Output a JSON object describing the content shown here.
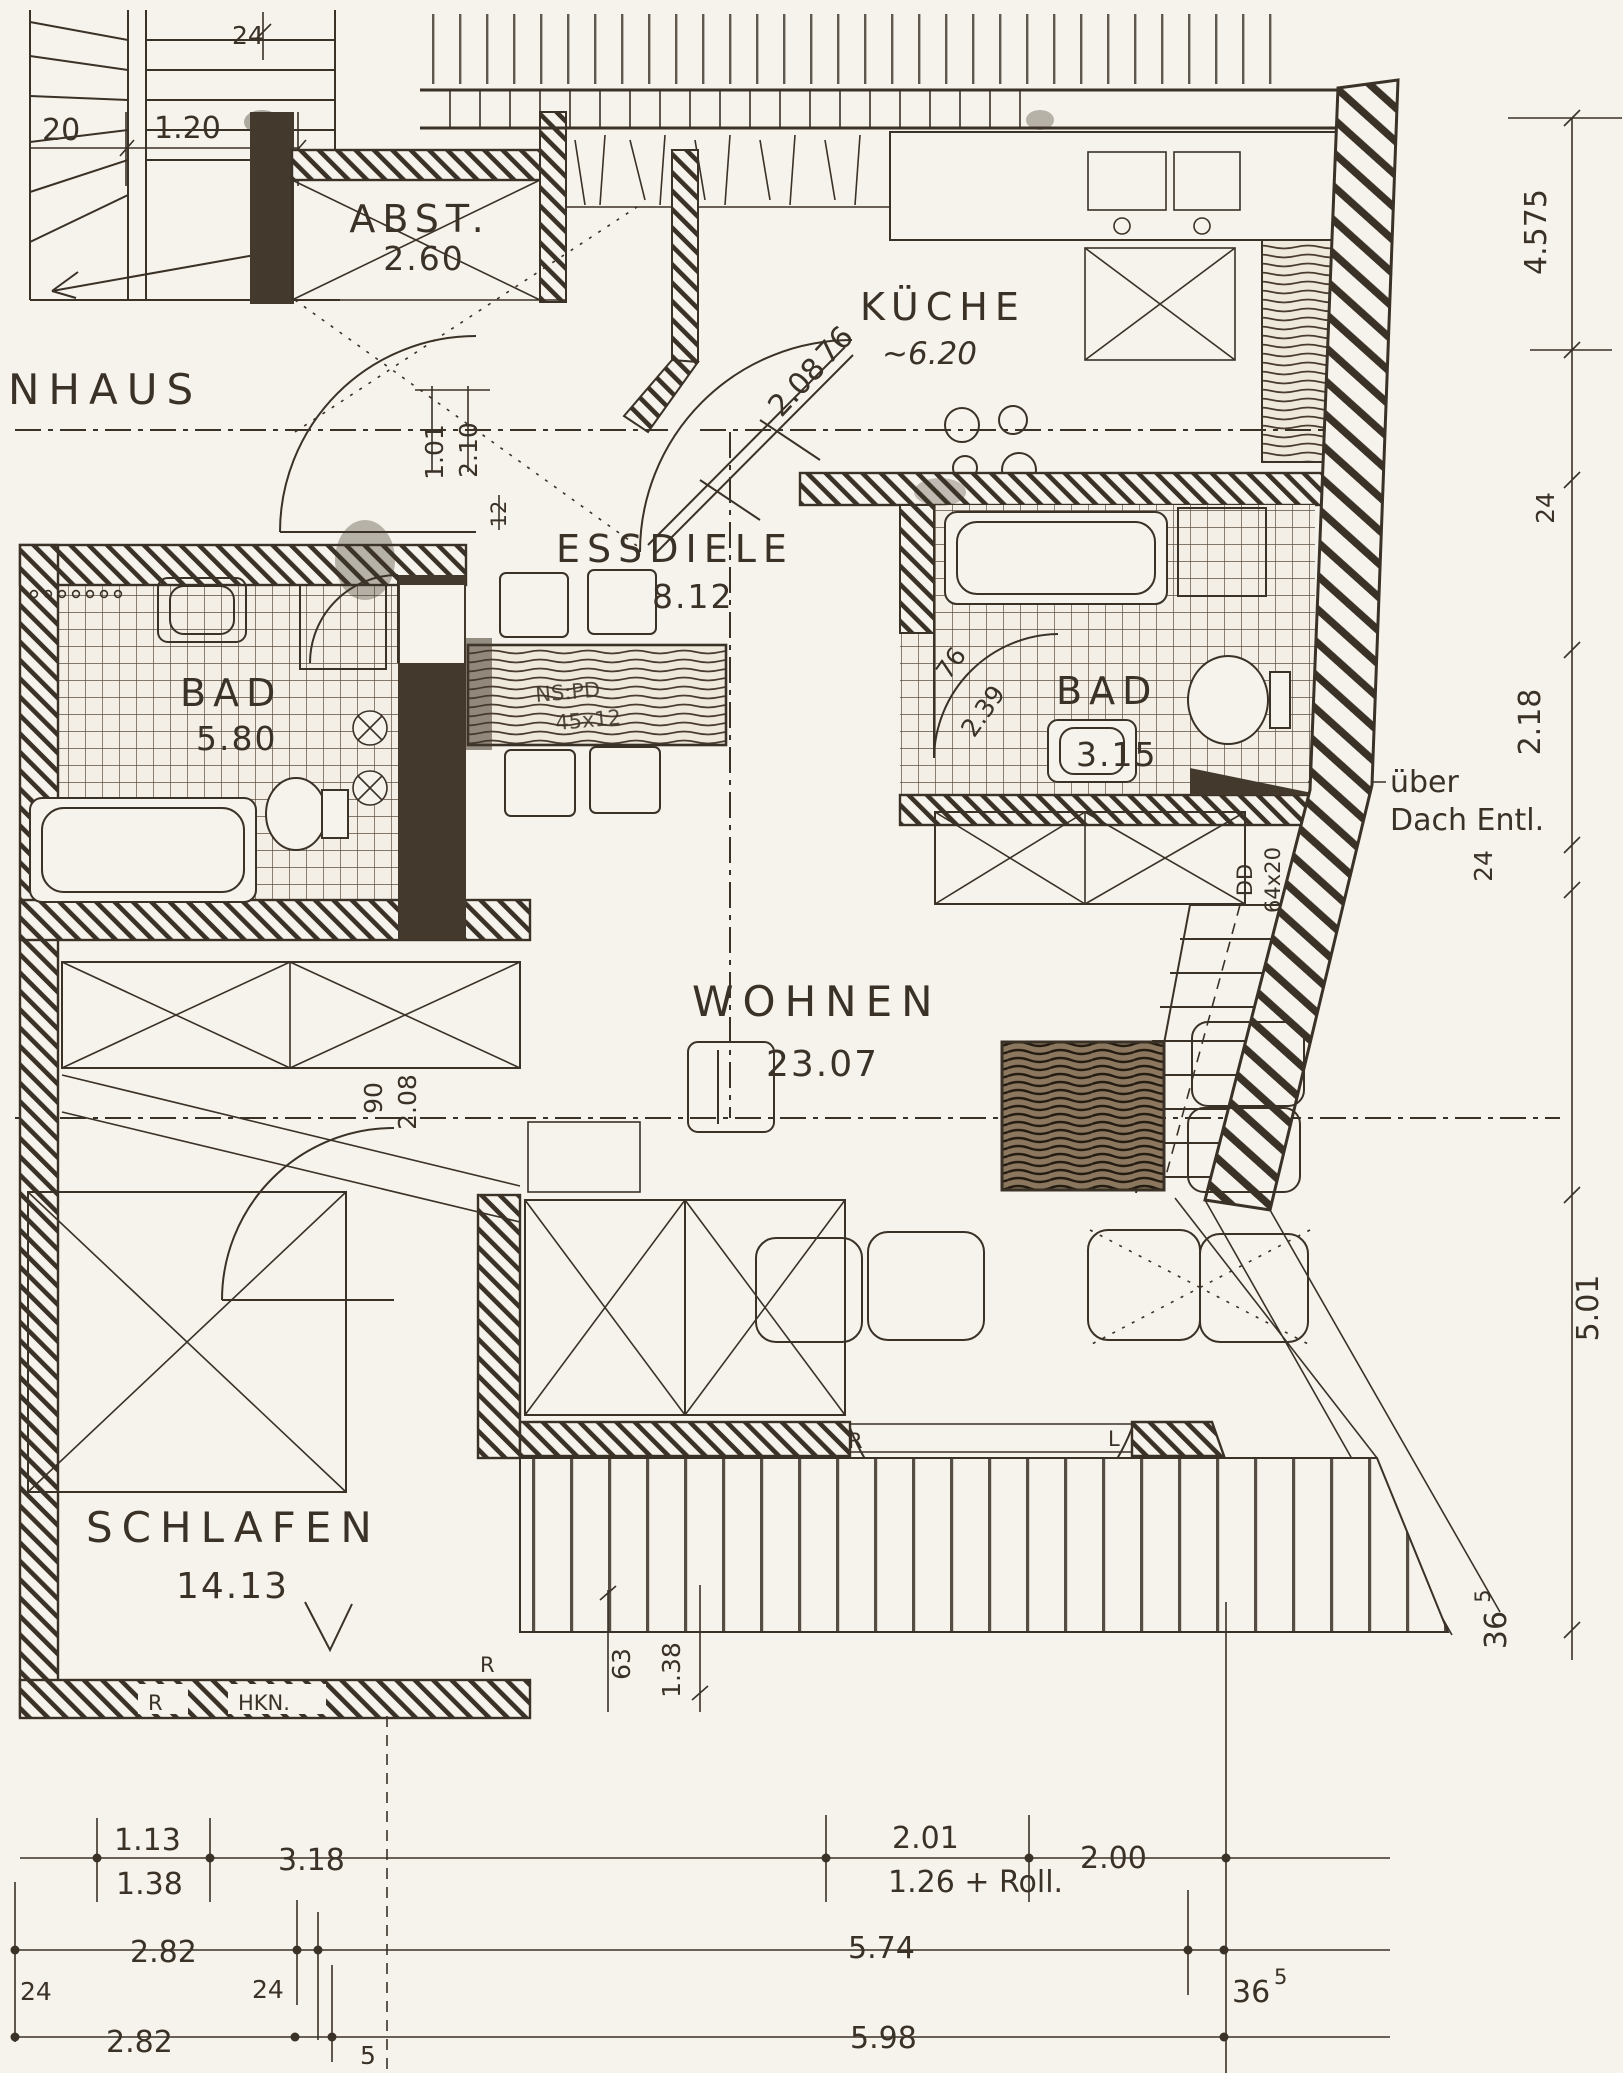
{
  "rooms": {
    "treppenhaus": {
      "label": "NHAUS"
    },
    "abstellraum": {
      "label": "ABST.",
      "area": "2.60"
    },
    "kueche": {
      "label": "KÜCHE",
      "area": "~6.20"
    },
    "essdiele": {
      "label": "ESSDIELE",
      "area": "8.12"
    },
    "bad_links": {
      "label": "BAD",
      "area": "5.80"
    },
    "bad_rechts": {
      "label": "BAD",
      "area": "3.15"
    },
    "wohnen": {
      "label": "WOHNEN",
      "area": "23.07"
    },
    "schlafen": {
      "label": "SCHLAFEN",
      "area": "14.13"
    }
  },
  "doors": {
    "kueche": {
      "width": "76",
      "height": "2.08"
    },
    "bad_rechts": {
      "width": "76",
      "height": "2.39"
    },
    "diele": {
      "width": "1.01",
      "height": "2.10"
    },
    "schlafen": {
      "width": "90",
      "height": "2.08"
    },
    "balkon": {
      "swing_left": "R",
      "swing_right": "L",
      "note": "2.06"
    }
  },
  "walls": {
    "thickness_hall": "12"
  },
  "annotations": {
    "vent_line1": "über",
    "vent_line2": "Dach Entl.",
    "duct_label": "DD",
    "duct_size": "64x20",
    "hook_rail": "HKN.",
    "r_schlafen": "R",
    "r_wohnen": "R",
    "table_note_1": "NS:PD",
    "table_note_2": "45x12"
  },
  "dimensions": {
    "stairs": {
      "tread": "20",
      "flight": "1.20",
      "wall": "24"
    },
    "right": {
      "top": "4.575",
      "wall_top": "24",
      "bad": "2.18",
      "wall_mid": "24",
      "wohnen": "5.01",
      "base_main": "36",
      "base_sup": "5"
    },
    "mid": {
      "a": "63",
      "b": "1.38"
    },
    "row1": {
      "a_top": "1.13",
      "a_bot": "1.38",
      "b": "3.18",
      "c_top": "2.01",
      "c_bot": "1.26 + Roll.",
      "d": "2.00"
    },
    "row2": {
      "a": "2.82",
      "wall_l": "24",
      "wall_m": "24",
      "b": "5.74",
      "c_main": "36",
      "c_sup": "5"
    },
    "row3": {
      "a": "2.82",
      "b": "5.98",
      "c": "5"
    }
  }
}
